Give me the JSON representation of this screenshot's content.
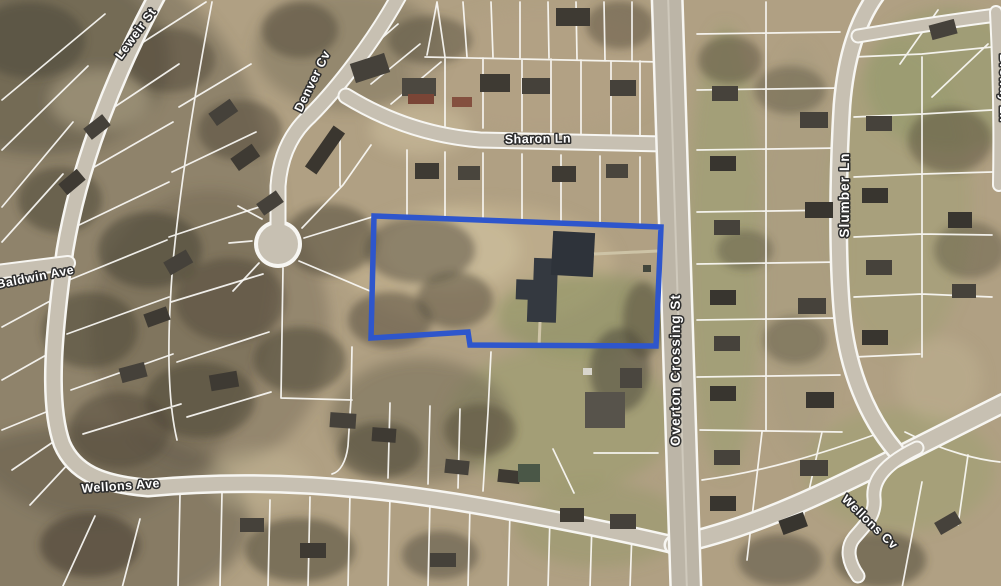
{
  "map": {
    "description": "Aerial parcel map with highlighted property outline",
    "palette": {
      "terrain_base": "#b0a083",
      "parcel_line": "#fbfaf6",
      "road_fill": "#c7c0b2",
      "highlight_stroke": "#2e56cc",
      "label_fill": "#ffffff",
      "label_halo": "#2e2e2e"
    },
    "highlight": {
      "name": "selected-parcel"
    },
    "streets": [
      {
        "id": "leweir-st",
        "label": "Leweir St"
      },
      {
        "id": "denver-cv",
        "label": "Denver Cv"
      },
      {
        "id": "sharon-ln",
        "label": "Sharon Ln"
      },
      {
        "id": "baldwin-ave",
        "label": "Baldwin Ave"
      },
      {
        "id": "overton-crossing-st",
        "label": "Overton Crossing St"
      },
      {
        "id": "slumber-ln",
        "label": "Slumber Ln"
      },
      {
        "id": "broway-ln",
        "label": "Broway Ln"
      },
      {
        "id": "wellons-ave",
        "label": "Wellons Ave"
      },
      {
        "id": "wellons-cv",
        "label": "Wellons Cv"
      }
    ]
  }
}
